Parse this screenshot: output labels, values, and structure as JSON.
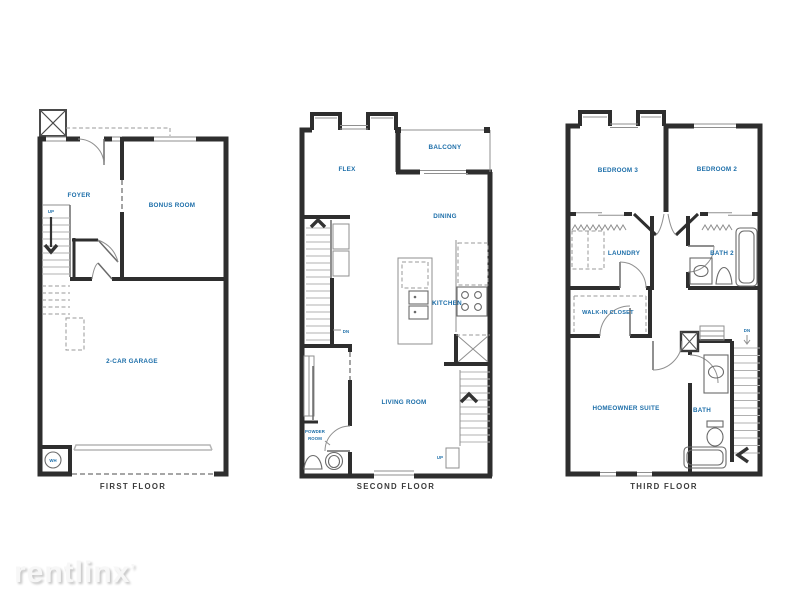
{
  "colors": {
    "wall": "#2e2e2e",
    "thin_line": "#8f8f8f",
    "fixture": "#6a6a6a",
    "label_blue": "#1c6ea9",
    "caption": "#3b3b3b",
    "background": "#ffffff",
    "watermark": "#f7f7f7"
  },
  "floors": {
    "first": {
      "title": "FIRST FLOOR",
      "labels": {
        "foyer": "FOYER",
        "bonus_room": "BONUS ROOM",
        "garage": "2-CAR GARAGE",
        "up": "UP",
        "water_heater": "WH"
      }
    },
    "second": {
      "title": "SECOND FLOOR",
      "labels": {
        "flex": "FLEX",
        "balcony": "BALCONY",
        "dining": "DINING",
        "kitchen": "KITCHEN",
        "living_room": "LIVING ROOM",
        "powder_line1": "POWDER",
        "powder_line2": "ROOM",
        "down": "DN",
        "up": "UP"
      }
    },
    "third": {
      "title": "THIRD FLOOR",
      "labels": {
        "bedroom3": "BEDROOM 3",
        "bedroom2": "BEDROOM 2",
        "laundry": "LAUNDRY",
        "bath2": "BATH 2",
        "walk_in_closet": "WALK-IN CLOSET",
        "homeowner_suite": "HOMEOWNER SUITE",
        "bath": "BATH",
        "down": "DN"
      }
    }
  },
  "watermark": {
    "text": "rentlinx",
    "mark": "ʼ"
  }
}
